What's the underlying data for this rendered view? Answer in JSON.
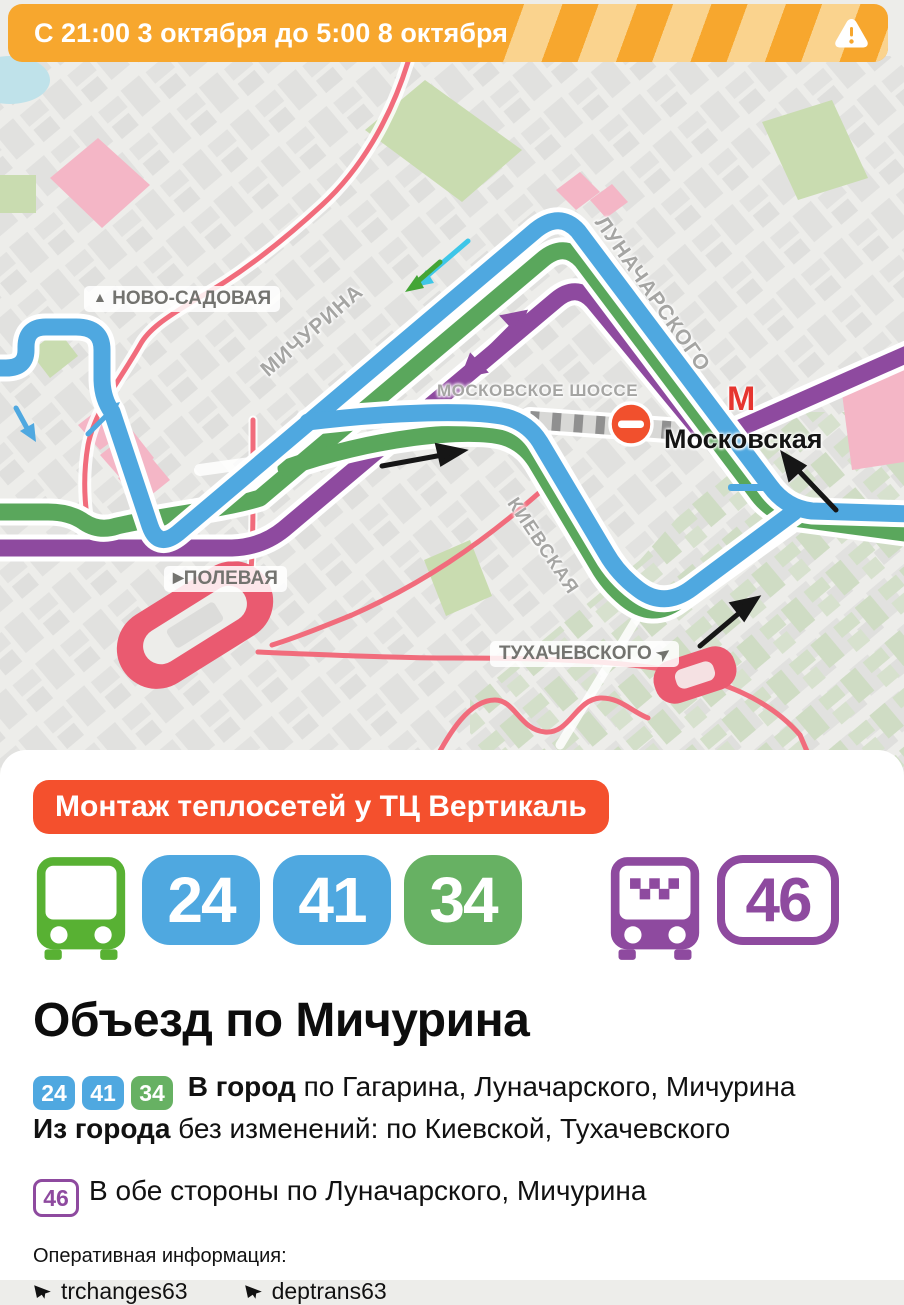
{
  "banner": {
    "text": "С 21:00 3 октября до 5:00 8 октября"
  },
  "map": {
    "labels": {
      "novo_prefix": "▲",
      "novo_sadovaya": "НОВО-САДОВАЯ",
      "michurina": "МИЧУРИНА",
      "moskovskoe_shosse": "МОСКОВСКОЕ ШОССЕ",
      "lunacharskogo": "ЛУНАЧАРСКОГО",
      "kievskaya": "КИЕВСКАЯ",
      "polevaya_prefix": "▶",
      "polevaya": "ПОЛЕВАЯ",
      "tukhachevskogo": "ТУХАЧЕВСКОГО",
      "tukh_suffix": "➤",
      "metro_letter": "М",
      "metro_station": "Московская"
    }
  },
  "card": {
    "reason": "Монтаж теплосетей у ТЦ Вертикаль",
    "routes_changed": [
      "24",
      "41",
      "34"
    ],
    "route_both_ways": "46",
    "title": "Объезд по Мичурина",
    "para1_badges": [
      "24",
      "41",
      "34"
    ],
    "para1_bold": "В город",
    "para1_rest": " по Гагарина, Луначарского, Мичурина",
    "para2_bold": "Из города",
    "para2_rest": " без изменений: по Киевской, Тухачевского",
    "para3_badge": "46",
    "para3_text": "В обе стороны по Луначарского, Мичурина",
    "footer_label": "Оперативная информация:",
    "channels": [
      "trchanges63",
      "deptrans63"
    ]
  },
  "colors": {
    "banner_orange": "#F7A72E",
    "banner_stripe": "#FAD38E",
    "accent_red": "#F4502D",
    "route_blue": "#4FA8E0",
    "route_green": "#5AA75C",
    "route_purple": "#8E4A9F",
    "badge_green": "#67B163",
    "metro_red": "#E6352F"
  }
}
